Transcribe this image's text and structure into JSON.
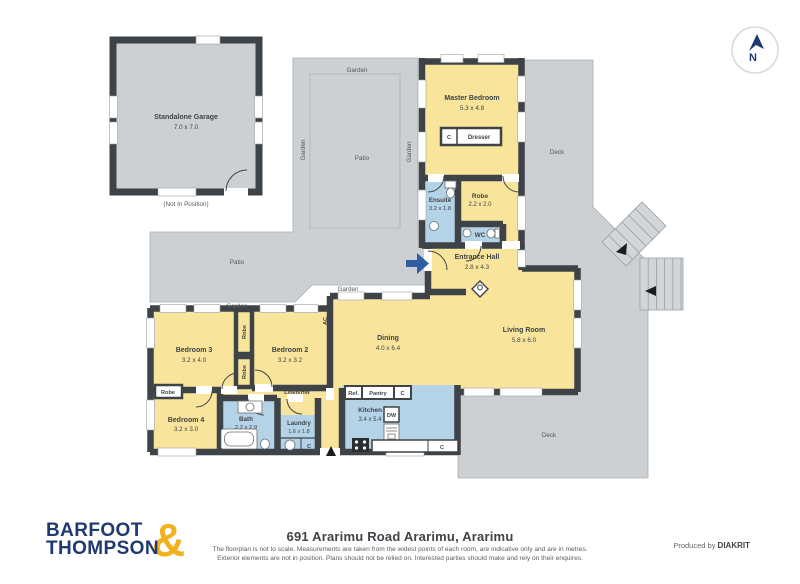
{
  "compass": {
    "north": "N"
  },
  "plan": {
    "garage": {
      "name": "Standalone Garage",
      "dims": "7.0 x 7.0",
      "note": "(Not In Position)"
    },
    "outdoor": {
      "garden": "Garden",
      "patio": "Patio",
      "deck": "Deck"
    },
    "rooms": {
      "master_bedroom": {
        "name": "Master Bedroom",
        "dims": "5.3 x 4.8"
      },
      "ensuite": {
        "name": "Ensuite",
        "dims": "3.2 x 1.8"
      },
      "robe_master": {
        "name": "Robe",
        "dims": "2.2 x 2.0"
      },
      "wc": {
        "name": "WC"
      },
      "entrance_hall": {
        "name": "Entrance Hall",
        "dims": "2.8 x 4.3"
      },
      "living_room": {
        "name": "Living Room",
        "dims": "5.8 x 6.0"
      },
      "dining": {
        "name": "Dining",
        "dims": "4.0 x 6.4"
      },
      "kitchen": {
        "name": "Kitchen",
        "dims": "3.4 x 5.4"
      },
      "bedroom2": {
        "name": "Bedroom 2",
        "dims": "3.2 x 3.2"
      },
      "bedroom3": {
        "name": "Bedroom 3",
        "dims": "3.2 x 4.0"
      },
      "bedroom4": {
        "name": "Bedroom 4",
        "dims": "3.2 x 3.0"
      },
      "bath": {
        "name": "Bath",
        "dims": "2.2 x 2.9"
      },
      "laundry": {
        "name": "Laundry",
        "dims": "1.6 x 1.8"
      },
      "linen": {
        "name": "Linen/HW"
      }
    },
    "small_labels": {
      "robe": "Robe",
      "ac": "AC",
      "c": "C",
      "dw": "DW",
      "ref": "Ref.",
      "pantry": "Pantry",
      "dresser": "Dresser"
    }
  },
  "footer": {
    "brand_line1": "BARFOOT",
    "brand_line2": "THOMPSON",
    "brand_amp": "&",
    "address": "691 Ararimu Road Ararimu, Ararimu",
    "disclaimer1": "The floorplan is not to scale. Measurements are taken from the widest points of each room, are indicative only and are in metres.",
    "disclaimer2": "Exterior elements are not in position. Plans should not be relied on. Interested parties should make and rely on their enquires.",
    "produced_by": "Produced by",
    "producer": "DIAKRIT"
  },
  "colors": {
    "wall": "#3E4347",
    "room_yellow": "#F9E49B",
    "wet_blue": "#B5D3E7",
    "outdoor_gray": "#CDD0D2",
    "entry_arrow_blue": "#2E5FA3",
    "brand_navy": "#1E3A70",
    "brand_gold": "#F2B21F"
  }
}
